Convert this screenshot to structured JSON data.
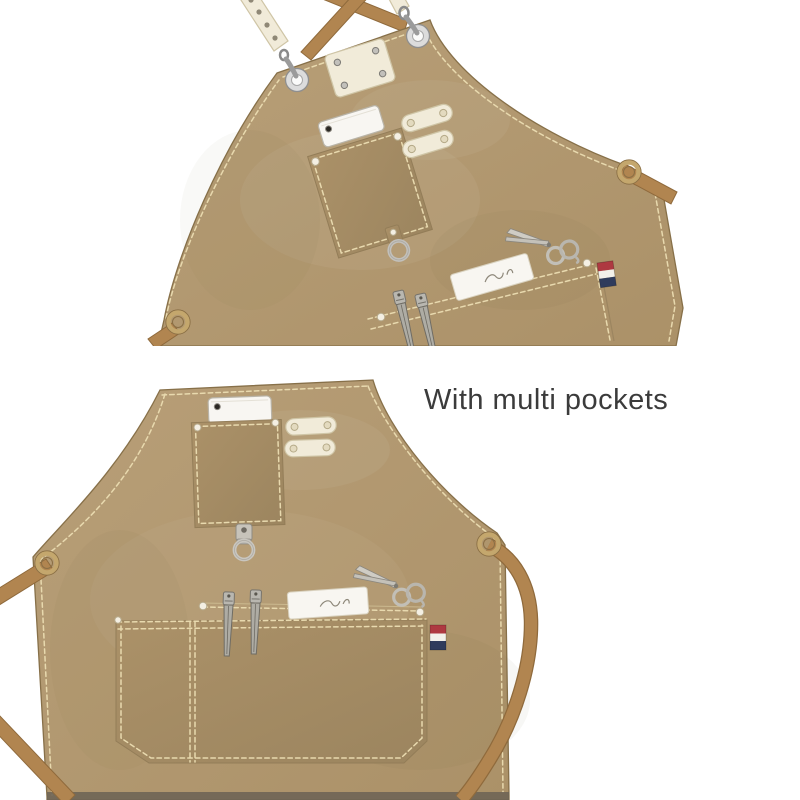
{
  "caption": {
    "text": "With multi pockets"
  },
  "palette": {
    "background": "#ffffff",
    "caption": "#3b3b3b",
    "canvas_light": "#b89f78",
    "canvas": "#ab9168",
    "canvas_dark": "#9c855f",
    "canvas_edge": "#877049",
    "stitch": "#e8d9ae",
    "strap": "#b18550",
    "strap_dark": "#8f6a3c",
    "white_leather": "#f1ebd9",
    "leather_edge": "#cfc5a6",
    "metal": "#c2c0bb",
    "metal_dark": "#7d7b76",
    "brass": "#c4a76d",
    "brass_dark": "#8a6f45",
    "pearl": "#f4efe3",
    "flag_red": "#ae3941",
    "flag_white": "#f2f0ea",
    "flag_navy": "#2f3b5c",
    "hem": "#6b6255"
  },
  "scenes": [
    {
      "id": "top-apron",
      "view": "tilted-hanging-front-view",
      "items": [
        "crossback-straps",
        "white-shoulder-strap",
        "snap-hooks",
        "eyelet-grommets",
        "rivet-patch",
        "phone",
        "chest-pocket",
        "snap-tabs",
        "d-ring",
        "tool-slot",
        "hair-clips",
        "label-card",
        "scissors",
        "flag-tag",
        "waist-strap"
      ]
    },
    {
      "id": "bottom-apron",
      "view": "straight-front-view",
      "items": [
        "phone",
        "chest-pocket",
        "snap-tabs",
        "d-ring",
        "tool-slot",
        "hair-clips",
        "label-card",
        "scissors",
        "flag-tag",
        "waist-straps",
        "large-front-pocket"
      ]
    }
  ]
}
